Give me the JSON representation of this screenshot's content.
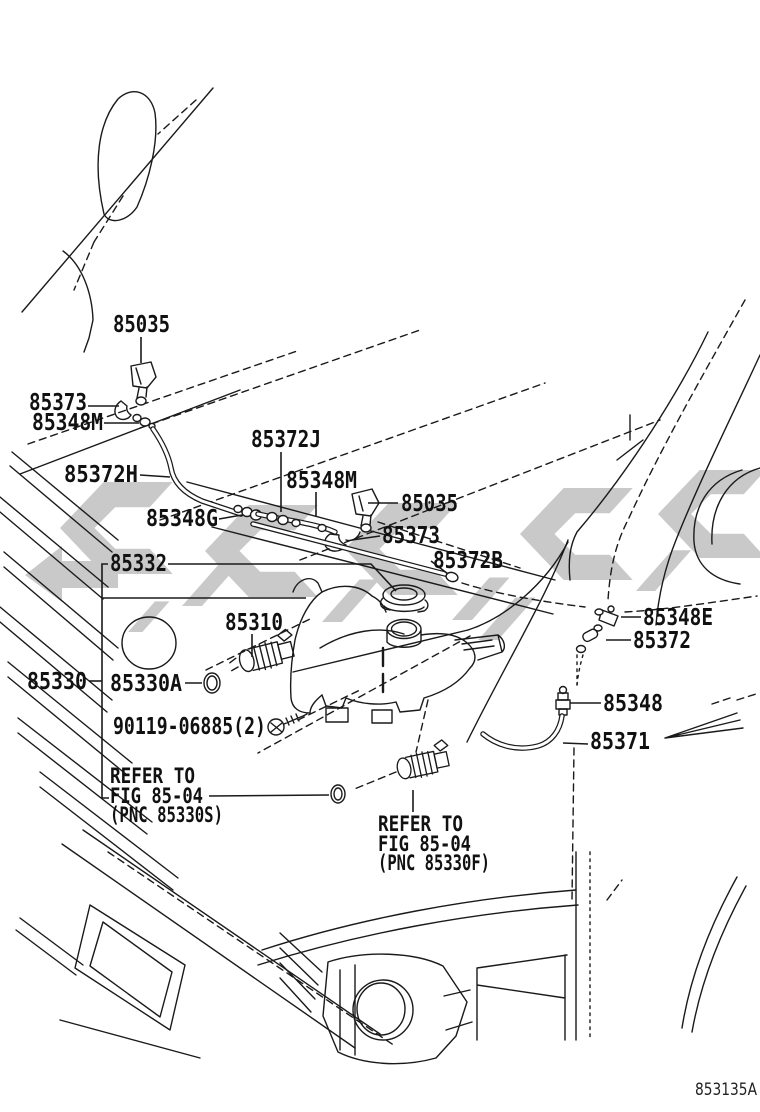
{
  "figure_code": "853135A",
  "colors": {
    "line": "#1a1a1a",
    "watermark": "#c9c9c9",
    "background": "#ffffff"
  },
  "labels": {
    "nozzle_top": "85035",
    "hose_elbow_left": "85373",
    "clip_left": "85348M",
    "hose_j": "85372J",
    "hose_h": "85372H",
    "clip_mid": "85348M",
    "nozzle_right": "85035",
    "joint_g": "85348G",
    "hose_elbow_right": "85373",
    "hose_b": "85372B",
    "tank_cap": "85332",
    "pump_front": "85310",
    "clip_e": "85348E",
    "grommet_pillar": "85372",
    "jar_assy": "85330",
    "jar_packing": "85330A",
    "check_valve": "85348",
    "screw": "90119-06885(2)",
    "hose_rear": "85371",
    "refer_s": {
      "line1": "REFER TO",
      "line2": "FIG 85-04",
      "line3": "(PNC 85330S)"
    },
    "refer_f": {
      "line1": "REFER TO",
      "line2": "FIG 85-04",
      "line3": "(PNC 85330F)"
    }
  }
}
